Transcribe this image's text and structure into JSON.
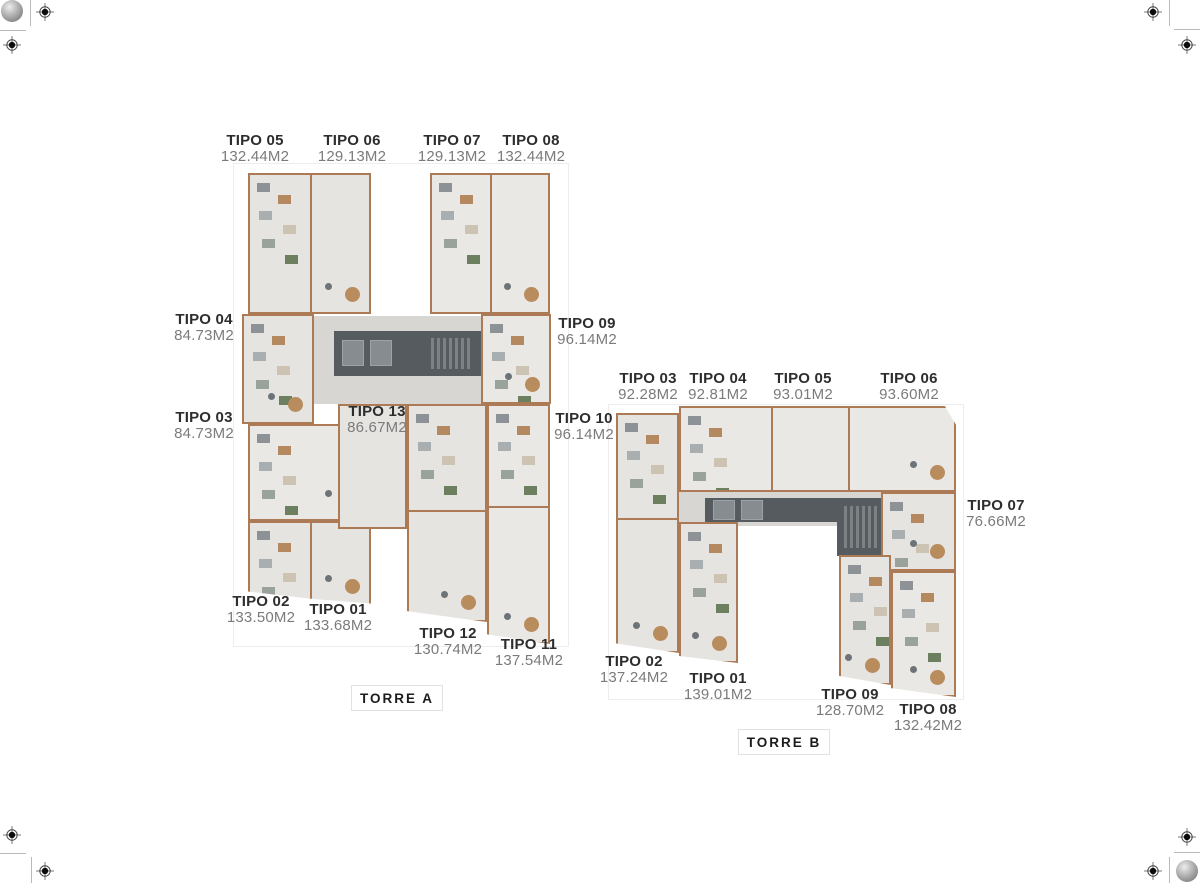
{
  "torre_a": {
    "name": "TORRE A",
    "units": [
      {
        "id": "TIPO 05",
        "area": "132.44M2"
      },
      {
        "id": "TIPO 06",
        "area": "129.13M2"
      },
      {
        "id": "TIPO 07",
        "area": "129.13M2"
      },
      {
        "id": "TIPO 08",
        "area": "132.44M2"
      },
      {
        "id": "TIPO 04",
        "area": "84.73M2"
      },
      {
        "id": "TIPO 03",
        "area": "84.73M2"
      },
      {
        "id": "TIPO 09",
        "area": "96.14M2"
      },
      {
        "id": "TIPO 10",
        "area": "96.14M2"
      },
      {
        "id": "TIPO 13",
        "area": "86.67M2"
      },
      {
        "id": "TIPO 02",
        "area": "133.50M2"
      },
      {
        "id": "TIPO 01",
        "area": "133.68M2"
      },
      {
        "id": "TIPO 12",
        "area": "130.74M2"
      },
      {
        "id": "TIPO 11",
        "area": "137.54M2"
      }
    ]
  },
  "torre_b": {
    "name": "TORRE B",
    "units": [
      {
        "id": "TIPO 03",
        "area": "92.28M2"
      },
      {
        "id": "TIPO 04",
        "area": "92.81M2"
      },
      {
        "id": "TIPO 05",
        "area": "93.01M2"
      },
      {
        "id": "TIPO 06",
        "area": "93.60M2"
      },
      {
        "id": "TIPO 07",
        "area": "76.66M2"
      },
      {
        "id": "TIPO 02",
        "area": "137.24M2"
      },
      {
        "id": "TIPO 01",
        "area": "139.01M2"
      },
      {
        "id": "TIPO 09",
        "area": "128.70M2"
      },
      {
        "id": "TIPO 08",
        "area": "132.42M2"
      }
    ]
  },
  "icons": {
    "registration_crosshair": "crosshair-target",
    "color_calibration_ball": "gradient-sphere"
  },
  "palette": {
    "outline_brown": "#ac7a55",
    "floor_gray": "#e5e4e1",
    "corridor_gray": "#d8d6d3",
    "core_dark": "#565b5f",
    "label_dark": "#2d2d2d",
    "label_gray": "#7b7b7b"
  }
}
